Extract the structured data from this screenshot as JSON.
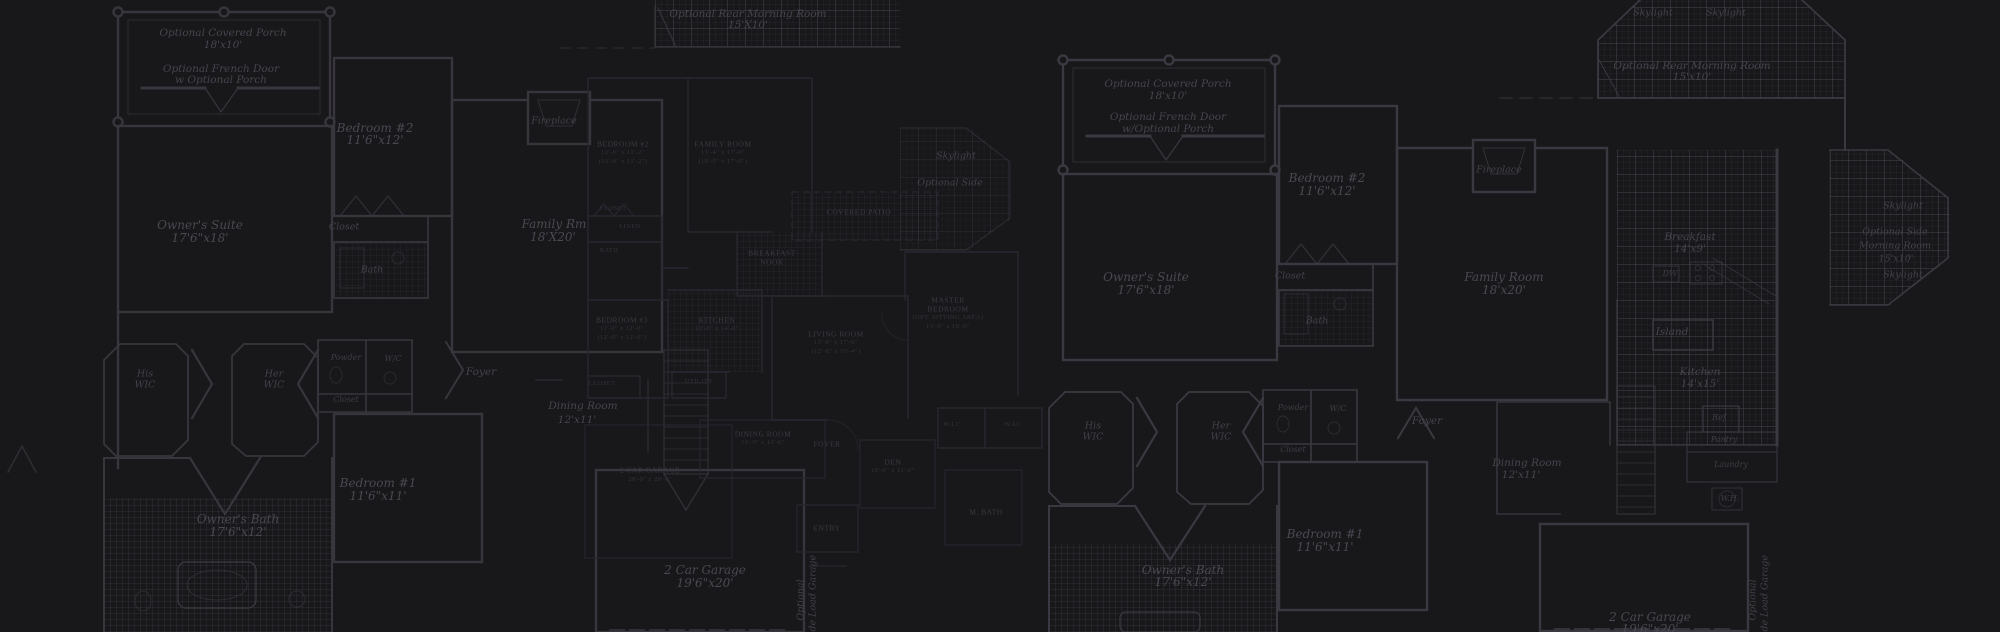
{
  "meta": {
    "description": "Dark blueprint floor-plan collage background",
    "canvas": {
      "width": 2000,
      "height": 632
    },
    "palette": {
      "background": "#18171a",
      "wall_strong": "#37363d",
      "wall_faint": "#282730",
      "tile_line": "#3a3c46",
      "label_bright": "#4a4952",
      "label_dim": "#34333c"
    }
  },
  "labels": [
    {
      "t": "Optional Covered Porch",
      "x": 223,
      "y": 33,
      "c": "s10"
    },
    {
      "t": "18'x10'",
      "x": 223,
      "y": 45,
      "c": "s10"
    },
    {
      "t": "Optional French Door",
      "x": 221,
      "y": 69,
      "c": "s10"
    },
    {
      "t": "w Optional Porch",
      "x": 221,
      "y": 80,
      "c": "s10"
    },
    {
      "t": "Owner's Suite",
      "x": 200,
      "y": 225,
      "c": "s11"
    },
    {
      "t": "17'6\"x18'",
      "x": 200,
      "y": 238,
      "c": "s11"
    },
    {
      "t": "Bedroom #2",
      "x": 375,
      "y": 128,
      "c": "s11"
    },
    {
      "t": "11'6\"x12'",
      "x": 375,
      "y": 140,
      "c": "s11"
    },
    {
      "t": "Closet",
      "x": 344,
      "y": 227,
      "c": "s9"
    },
    {
      "t": "Bath",
      "x": 372,
      "y": 270,
      "c": "s9"
    },
    {
      "t": "Family Rm",
      "x": 554,
      "y": 224,
      "c": "s11"
    },
    {
      "t": "18'X20'",
      "x": 553,
      "y": 237,
      "c": "s11"
    },
    {
      "t": "Fireplace",
      "x": 554,
      "y": 121,
      "c": "s9"
    },
    {
      "t": "His",
      "x": 145,
      "y": 374,
      "c": "s9"
    },
    {
      "t": "WIC",
      "x": 145,
      "y": 385,
      "c": "s9"
    },
    {
      "t": "Her",
      "x": 274,
      "y": 374,
      "c": "s9"
    },
    {
      "t": "WIC",
      "x": 274,
      "y": 385,
      "c": "s9"
    },
    {
      "t": "Powder",
      "x": 346,
      "y": 358,
      "c": "t7"
    },
    {
      "t": "W/C",
      "x": 393,
      "y": 359,
      "c": "t7"
    },
    {
      "t": "Closet",
      "x": 346,
      "y": 400,
      "c": "t7"
    },
    {
      "t": "Foyer",
      "x": 481,
      "y": 372,
      "c": "s10"
    },
    {
      "t": "Bedroom #1",
      "x": 378,
      "y": 483,
      "c": "s11"
    },
    {
      "t": "11'6\"x11'",
      "x": 378,
      "y": 496,
      "c": "s11"
    },
    {
      "t": "Owner's Bath",
      "x": 238,
      "y": 519,
      "c": "s11"
    },
    {
      "t": "17'6\"x12'",
      "x": 238,
      "y": 532,
      "c": "s11"
    },
    {
      "t": "Dining Room",
      "x": 583,
      "y": 406,
      "c": "s10"
    },
    {
      "t": "12'x11'",
      "x": 577,
      "y": 420,
      "c": "s10"
    },
    {
      "t": "2 Car Garage",
      "x": 705,
      "y": 570,
      "c": "s11"
    },
    {
      "t": "19'6\"x20'",
      "x": 705,
      "y": 583,
      "c": "s11"
    },
    {
      "t": "Optional",
      "x": 801,
      "y": 600,
      "c": "s9",
      "r": 1
    },
    {
      "t": "Side Load Garage",
      "x": 813,
      "y": 598,
      "c": "s9",
      "r": 1
    },
    {
      "t": "Skylight",
      "x": 956,
      "y": 156,
      "c": "s9"
    },
    {
      "t": "Optional Side",
      "x": 950,
      "y": 183,
      "c": "s9"
    },
    {
      "t": "Optional Rear Morning Room",
      "x": 748,
      "y": 14,
      "c": "s10"
    },
    {
      "t": "15'X10'",
      "x": 748,
      "y": 25,
      "c": "s10"
    },
    {
      "t": "BEDROOM #2",
      "x": 623,
      "y": 144,
      "c": "c7"
    },
    {
      "t": "12'-0\" x 11'-2\"",
      "x": 623,
      "y": 153,
      "c": "c6"
    },
    {
      "t": "(13'-0\" x 11'-2\")",
      "x": 623,
      "y": 162,
      "c": "c6"
    },
    {
      "t": "FAMILY ROOM",
      "x": 723,
      "y": 144,
      "c": "c7"
    },
    {
      "t": "15'-4\" x 17'-0\"",
      "x": 723,
      "y": 153,
      "c": "c6"
    },
    {
      "t": "(19'-0\" x 17'-0\")",
      "x": 723,
      "y": 162,
      "c": "c6"
    },
    {
      "t": "CLOSET",
      "x": 613,
      "y": 209,
      "c": "c6"
    },
    {
      "t": "LINEN",
      "x": 630,
      "y": 227,
      "c": "c6"
    },
    {
      "t": "BATH",
      "x": 609,
      "y": 251,
      "c": "c6"
    },
    {
      "t": "BEDROOM #3",
      "x": 622,
      "y": 320,
      "c": "c7"
    },
    {
      "t": "11'-0\" x 12'-0\"",
      "x": 622,
      "y": 329,
      "c": "c6"
    },
    {
      "t": "(12'-0\" x 12'-0\")",
      "x": 622,
      "y": 338,
      "c": "c6"
    },
    {
      "t": "CLOSET",
      "x": 602,
      "y": 384,
      "c": "c6"
    },
    {
      "t": "KITCHEN",
      "x": 717,
      "y": 320,
      "c": "c7"
    },
    {
      "t": "10'-8\" x 14'-0\"",
      "x": 717,
      "y": 329,
      "c": "c6"
    },
    {
      "t": "UTILITY",
      "x": 699,
      "y": 382,
      "c": "c6"
    },
    {
      "t": "BREAKFAST",
      "x": 772,
      "y": 253,
      "c": "c7"
    },
    {
      "t": "NOOK",
      "x": 772,
      "y": 262,
      "c": "c7"
    },
    {
      "t": "COVERED PATIO",
      "x": 859,
      "y": 212,
      "c": "c7"
    },
    {
      "t": "LIVING ROOM",
      "x": 836,
      "y": 334,
      "c": "c7"
    },
    {
      "t": "13'-6\" x 17'-6\"",
      "x": 836,
      "y": 343,
      "c": "c6"
    },
    {
      "t": "(12'-8\" x 19'-4\")",
      "x": 836,
      "y": 352,
      "c": "c6"
    },
    {
      "t": "MASTER",
      "x": 948,
      "y": 300,
      "c": "c7"
    },
    {
      "t": "BEDROOM",
      "x": 948,
      "y": 309,
      "c": "c7"
    },
    {
      "t": "(OPT. SITTING AREA)",
      "x": 948,
      "y": 318,
      "c": "c6"
    },
    {
      "t": "13'-0\" x 16'-0\"",
      "x": 948,
      "y": 327,
      "c": "c6"
    },
    {
      "t": "DINING ROOM",
      "x": 763,
      "y": 434,
      "c": "c7"
    },
    {
      "t": "11'-0\" x 13'-6\"",
      "x": 763,
      "y": 443,
      "c": "c6"
    },
    {
      "t": "FOYER",
      "x": 827,
      "y": 444,
      "c": "c7"
    },
    {
      "t": "DEN",
      "x": 893,
      "y": 462,
      "c": "c7"
    },
    {
      "t": "10'-0\" x 11'-0\"",
      "x": 893,
      "y": 471,
      "c": "c6"
    },
    {
      "t": "W.I.C.",
      "x": 953,
      "y": 425,
      "c": "c6"
    },
    {
      "t": "W.I.C.",
      "x": 1014,
      "y": 425,
      "c": "c6"
    },
    {
      "t": "M. BATH",
      "x": 986,
      "y": 512,
      "c": "c7"
    },
    {
      "t": "ENTRY",
      "x": 827,
      "y": 528,
      "c": "c7"
    },
    {
      "t": "2 CAR GARAGE",
      "x": 650,
      "y": 470,
      "c": "c7"
    },
    {
      "t": "20'-0\" x 20'-0\"",
      "x": 650,
      "y": 480,
      "c": "c6"
    },
    {
      "t": "Optional Covered Porch",
      "x": 1168,
      "y": 84,
      "c": "s10"
    },
    {
      "t": "18'x10'",
      "x": 1168,
      "y": 96,
      "c": "s10"
    },
    {
      "t": "Optional French Door",
      "x": 1168,
      "y": 117,
      "c": "s10"
    },
    {
      "t": "w/Optional Porch",
      "x": 1168,
      "y": 129,
      "c": "s10"
    },
    {
      "t": "Owner's Suite",
      "x": 1146,
      "y": 277,
      "c": "s11"
    },
    {
      "t": "17'6\"x18'",
      "x": 1146,
      "y": 290,
      "c": "s11"
    },
    {
      "t": "Bedroom #2",
      "x": 1327,
      "y": 178,
      "c": "s11"
    },
    {
      "t": "11'6\"x12'",
      "x": 1327,
      "y": 191,
      "c": "s11"
    },
    {
      "t": "Closet",
      "x": 1290,
      "y": 276,
      "c": "s9"
    },
    {
      "t": "Bath",
      "x": 1317,
      "y": 321,
      "c": "s9"
    },
    {
      "t": "Family Room",
      "x": 1504,
      "y": 277,
      "c": "s11"
    },
    {
      "t": "18'x20'",
      "x": 1504,
      "y": 290,
      "c": "s11"
    },
    {
      "t": "Fireplace",
      "x": 1499,
      "y": 170,
      "c": "s9"
    },
    {
      "t": "Skylight",
      "x": 1653,
      "y": 13,
      "c": "s9"
    },
    {
      "t": "Skylight",
      "x": 1726,
      "y": 13,
      "c": "s9"
    },
    {
      "t": "Optional Rear Morning Room",
      "x": 1692,
      "y": 66,
      "c": "s10"
    },
    {
      "t": "15'x10'",
      "x": 1692,
      "y": 77,
      "c": "s10"
    },
    {
      "t": "Breakfast",
      "x": 1690,
      "y": 237,
      "c": "s10"
    },
    {
      "t": "14'x9'",
      "x": 1690,
      "y": 249,
      "c": "s10"
    },
    {
      "t": "DW",
      "x": 1670,
      "y": 274,
      "c": "t7"
    },
    {
      "t": "Island",
      "x": 1672,
      "y": 332,
      "c": "s10"
    },
    {
      "t": "Kitchen",
      "x": 1700,
      "y": 372,
      "c": "s10"
    },
    {
      "t": "14'x15'",
      "x": 1700,
      "y": 384,
      "c": "s10"
    },
    {
      "t": "Ref",
      "x": 1719,
      "y": 418,
      "c": "t7"
    },
    {
      "t": "Pantry",
      "x": 1724,
      "y": 440,
      "c": "t7"
    },
    {
      "t": "Laundry",
      "x": 1731,
      "y": 465,
      "c": "t7"
    },
    {
      "t": "W.H.",
      "x": 1730,
      "y": 499,
      "c": "t7"
    },
    {
      "t": "Dining Room",
      "x": 1527,
      "y": 463,
      "c": "s10"
    },
    {
      "t": "12'x11'",
      "x": 1521,
      "y": 475,
      "c": "s10"
    },
    {
      "t": "Skylight",
      "x": 1903,
      "y": 206,
      "c": "s9"
    },
    {
      "t": "Optional Side",
      "x": 1895,
      "y": 232,
      "c": "s9"
    },
    {
      "t": "Morning Room",
      "x": 1895,
      "y": 246,
      "c": "s9"
    },
    {
      "t": "15'x10'",
      "x": 1896,
      "y": 259,
      "c": "s9"
    },
    {
      "t": "Skylight",
      "x": 1903,
      "y": 275,
      "c": "s9"
    },
    {
      "t": "Foyer",
      "x": 1427,
      "y": 421,
      "c": "s10"
    },
    {
      "t": "His",
      "x": 1093,
      "y": 426,
      "c": "s9"
    },
    {
      "t": "WIC",
      "x": 1093,
      "y": 437,
      "c": "s9"
    },
    {
      "t": "Her",
      "x": 1221,
      "y": 426,
      "c": "s9"
    },
    {
      "t": "WIC",
      "x": 1221,
      "y": 437,
      "c": "s9"
    },
    {
      "t": "Powder",
      "x": 1293,
      "y": 408,
      "c": "t7"
    },
    {
      "t": "W/C",
      "x": 1338,
      "y": 409,
      "c": "t7"
    },
    {
      "t": "Closet",
      "x": 1293,
      "y": 450,
      "c": "t7"
    },
    {
      "t": "Bedroom #1",
      "x": 1325,
      "y": 534,
      "c": "s11"
    },
    {
      "t": "11'6\"x11'",
      "x": 1325,
      "y": 547,
      "c": "s11"
    },
    {
      "t": "Owner's Bath",
      "x": 1183,
      "y": 570,
      "c": "s11"
    },
    {
      "t": "17'6\"x12'",
      "x": 1183,
      "y": 582,
      "c": "s11"
    },
    {
      "t": "2 Car Garage",
      "x": 1650,
      "y": 617,
      "c": "s11"
    },
    {
      "t": "19'6\"x20'",
      "x": 1650,
      "y": 629,
      "c": "s11"
    },
    {
      "t": "Optional",
      "x": 1753,
      "y": 600,
      "c": "s9",
      "r": 1
    },
    {
      "t": "Side Load Garage",
      "x": 1765,
      "y": 598,
      "c": "s9",
      "r": 1
    }
  ]
}
